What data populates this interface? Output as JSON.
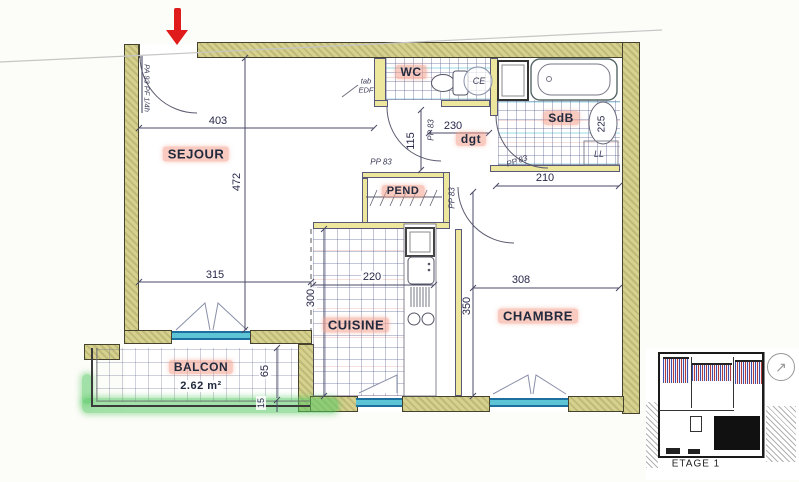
{
  "rooms": {
    "sejour": "SEJOUR",
    "wc": "WC",
    "sdb": "SdB",
    "dgt": "dgt",
    "pend": "PEND",
    "cuisine": "CUISINE",
    "chambre": "CHAMBRE",
    "balcon": "BALCON",
    "balcon_area": "2.62 m²"
  },
  "dims": {
    "sejour_top": "403",
    "sejour_side": "472",
    "sejour_bottom": "315",
    "hall_width": "230",
    "hall_depth": "115",
    "sdb_width": "210",
    "sdb_basin": "225",
    "cuisine_width": "220",
    "cuisine_depth": "300",
    "chambre_width": "308",
    "chambre_depth": "350",
    "balcon_depth": "65",
    "balcon_edge": "15"
  },
  "doors": {
    "entrance_spec": "PA 93 PF 1/4h",
    "interior_spec": "PP 83"
  },
  "fixtures": {
    "water_heater": "CE",
    "washing_machine": "LL",
    "edf_line1": "tab",
    "edf_line2": "EDF"
  },
  "inset": {
    "caption": "ETAGE 1"
  },
  "colors": {
    "wall_fill": "#d6d18c",
    "window_teal": "#5cc4d5",
    "label_highlight": "#f49e8a",
    "marker_green": "#56c862",
    "arrow_red": "#e01b1b"
  }
}
